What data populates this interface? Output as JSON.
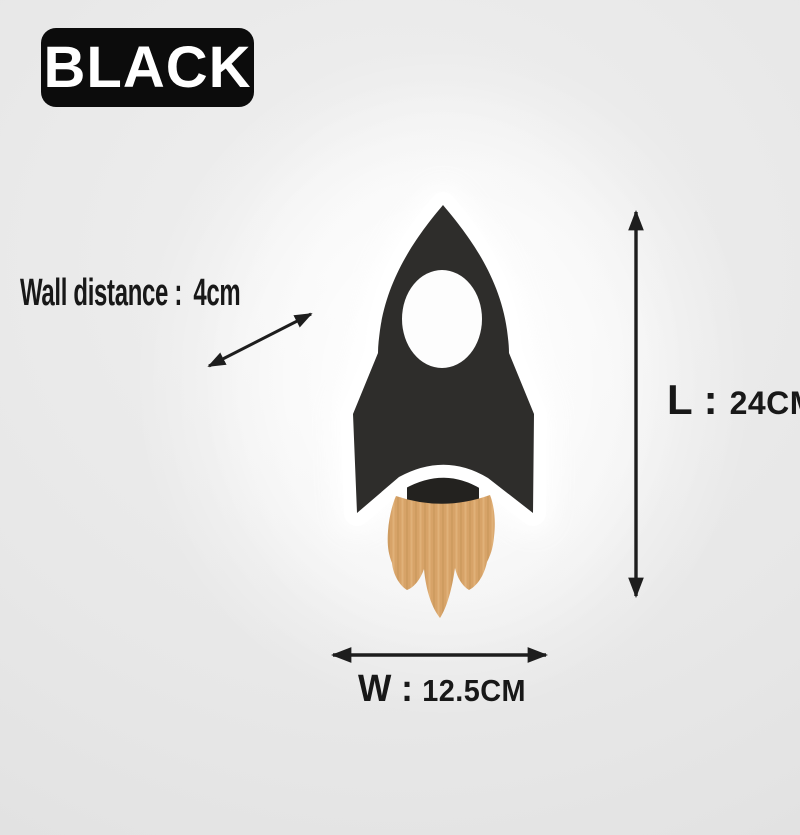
{
  "badge": {
    "label": "BLACK",
    "bg_color": "#0c0c0c",
    "text_color": "#ffffff"
  },
  "annotations": {
    "wall_distance": {
      "label": "Wall distance :",
      "value": "4cm"
    },
    "length": {
      "label": "L :",
      "value": "24CM"
    },
    "width": {
      "label": "W :",
      "value": "12.5CM"
    },
    "arrow_color": "#1d1d1d"
  },
  "product": {
    "name": "rocket-wall-lamp",
    "body_color": "#2e2d2b",
    "nozzle_color": "#23221f",
    "outline_color": "#ffffff",
    "window_color": "#fdfdfd",
    "wood_base_color": "#d7a368",
    "wood_grain_dark": "#c08d50",
    "wood_grain_light": "#e6bb83"
  },
  "background": {
    "base": "#e4e4e4",
    "center_light": "#f1f1f1"
  }
}
